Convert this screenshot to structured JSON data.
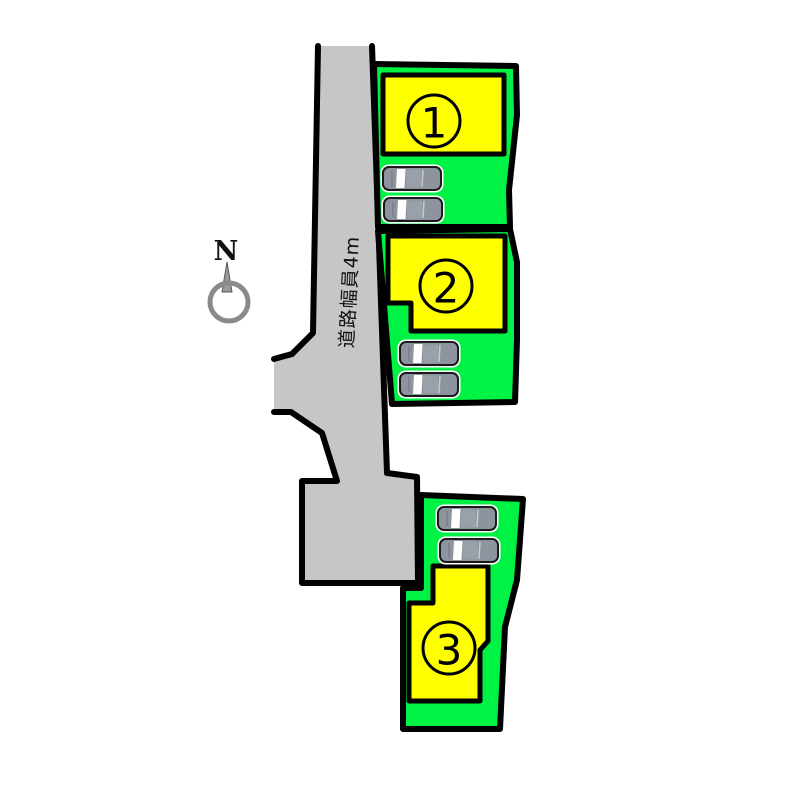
{
  "plan": {
    "compass_label": "N",
    "road_label": "道路幅員4m",
    "lots": [
      {
        "number": "1",
        "cars": 2
      },
      {
        "number": "2",
        "cars": 2
      },
      {
        "number": "3",
        "cars": 2
      }
    ],
    "colors": {
      "lot_green": "#00F344",
      "building_yellow": "#FFFF00",
      "road_gray": "#C6C6C6",
      "outline": "#000000",
      "car_gray": "#8E949D",
      "car_roof_gray": "#9AA0AA",
      "compass_gray": "#8A8A8A"
    }
  }
}
